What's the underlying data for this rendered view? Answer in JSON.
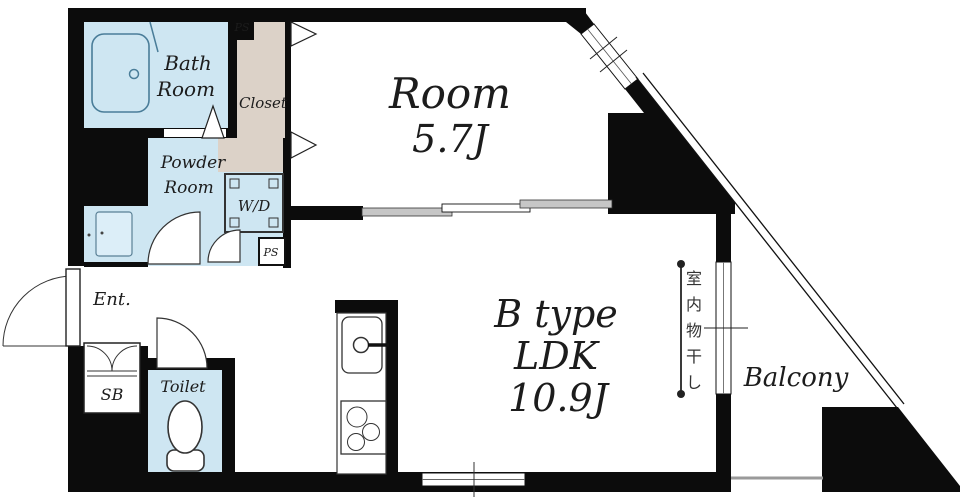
{
  "floorplan": {
    "colors": {
      "wet": "#cee6f2",
      "closet": "#dcd2c8",
      "wall": "#0c0c0c",
      "panel": "#c6c6c6"
    },
    "labels": {
      "bath_line1": "Bath",
      "bath_line2": "Room",
      "powder_line1": "Powder",
      "powder_line2": "Room",
      "closet": "Closet",
      "wd": "W/D",
      "ps_top": "PS",
      "ps_mid": "PS",
      "ent": "Ent.",
      "sb": "SB",
      "toilet": "Toilet",
      "room_line1": "Room",
      "room_line2": "5.7J",
      "ldk_line1": "B type",
      "ldk_line2": "LDK",
      "ldk_line3": "10.9J",
      "balcony": "Balcony",
      "laundry_vertical": "室内物干し"
    }
  }
}
